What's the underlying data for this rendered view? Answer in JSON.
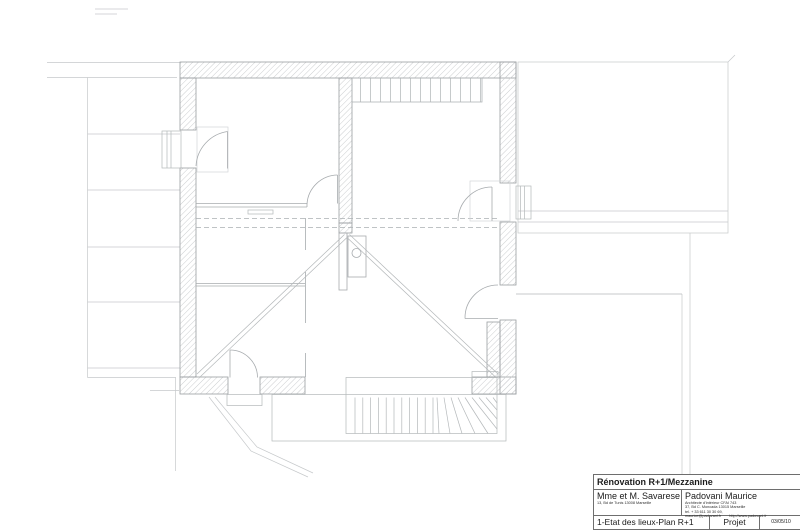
{
  "palette": {
    "background": "#ffffff",
    "line": "#a7abae",
    "faint": "#c6c9cb",
    "wall_outline": "#9a9ea1",
    "hatch": "#ccced0",
    "text": "#1b1b1b",
    "block_border": "#6e6e6e"
  },
  "title_block": {
    "project_title": "Rénovation R+1/Mezzanine",
    "client_name": "Mme et M. Savarese",
    "client_address": "13, Bd de Tunis 13008 Marseille",
    "architect_name": "Padovani Maurice",
    "architect_line1": "Architecte d'intérieur CFAI 743",
    "architect_line2": "37, Bd C. Moncada 13015 Marseille",
    "architect_line3": "tel. + 33 611 30 30 69,",
    "architect_email": "maurice@padovani.fr",
    "architect_web": "http://www.padovani.fr",
    "drawing_title": "1-Etat des lieux-Plan R+1",
    "phase_label": "Projet",
    "date": "03/05/10"
  },
  "drawing": {
    "type": "architectural-floor-plan",
    "level": "R+1",
    "features": [
      "hatched-exterior-walls",
      "interior-partitions",
      "door-swings",
      "window-bays",
      "roof-terrace-right",
      "skylight-band",
      "exterior-stair-with-winders",
      "mezzanine-dashed-edge",
      "void-diagonals",
      "flue-with-circle",
      "neighbouring-building-left"
    ]
  }
}
